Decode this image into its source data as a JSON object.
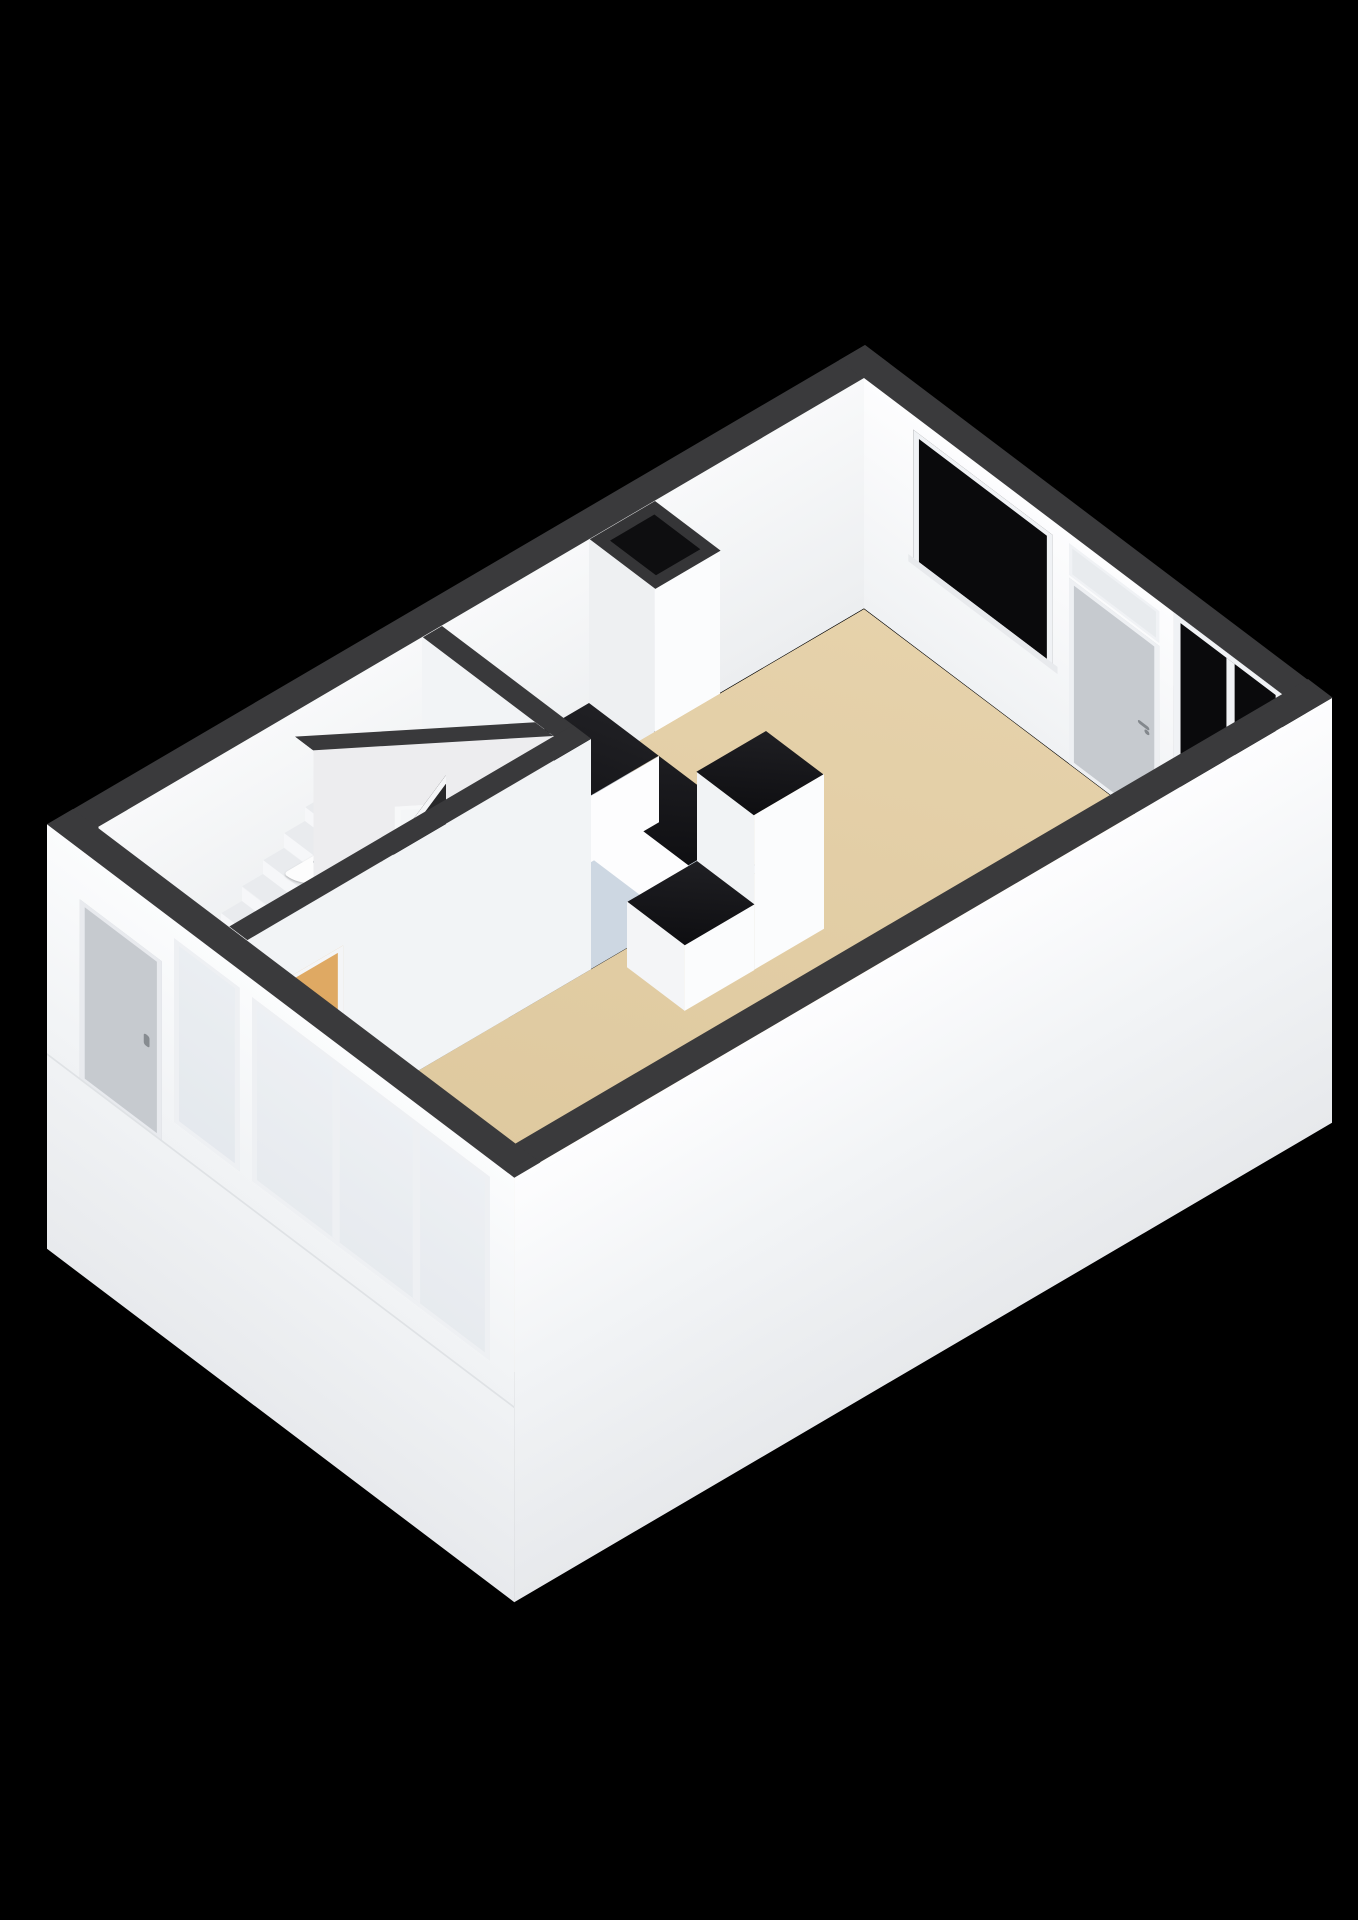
{
  "title": "3D isometric cutaway floor plan - ground floor",
  "colors": {
    "background": "#000000",
    "wall_top": "#3a3a3c",
    "wall_face": "#f4f6f8",
    "floor_living": "#e2cda4",
    "floor_kitchen": "#cdd7e2",
    "floor_hall": "#edeff1",
    "floor_toilet": "#f4f6f7",
    "counter_top_black": "#141417",
    "window_glass_dark": "#0a0a0c",
    "window_frame": "#f0f2f5",
    "exterior_door_gray": "#c6cacf",
    "interior_door_tan": "#dfa963",
    "stair_balustrade_black": "#28282a",
    "stair_tread": "#e9ebee",
    "fixture_metal": "#9aa0a6"
  },
  "scene": {
    "view": "axonometric cutaway, viewed from above",
    "rooms": [
      "living-room",
      "kitchen",
      "toilet",
      "hall-with-stairs"
    ],
    "fixtures": [
      "kitchen-counter-with-round-sink",
      "tall-cabinet",
      "peninsula-cabinet",
      "duct-shaft",
      "corner-washbasin",
      "staircase-with-winders",
      "radiator-box",
      "front-door",
      "terrace-door",
      "sliding-window",
      "facade-windows"
    ]
  }
}
